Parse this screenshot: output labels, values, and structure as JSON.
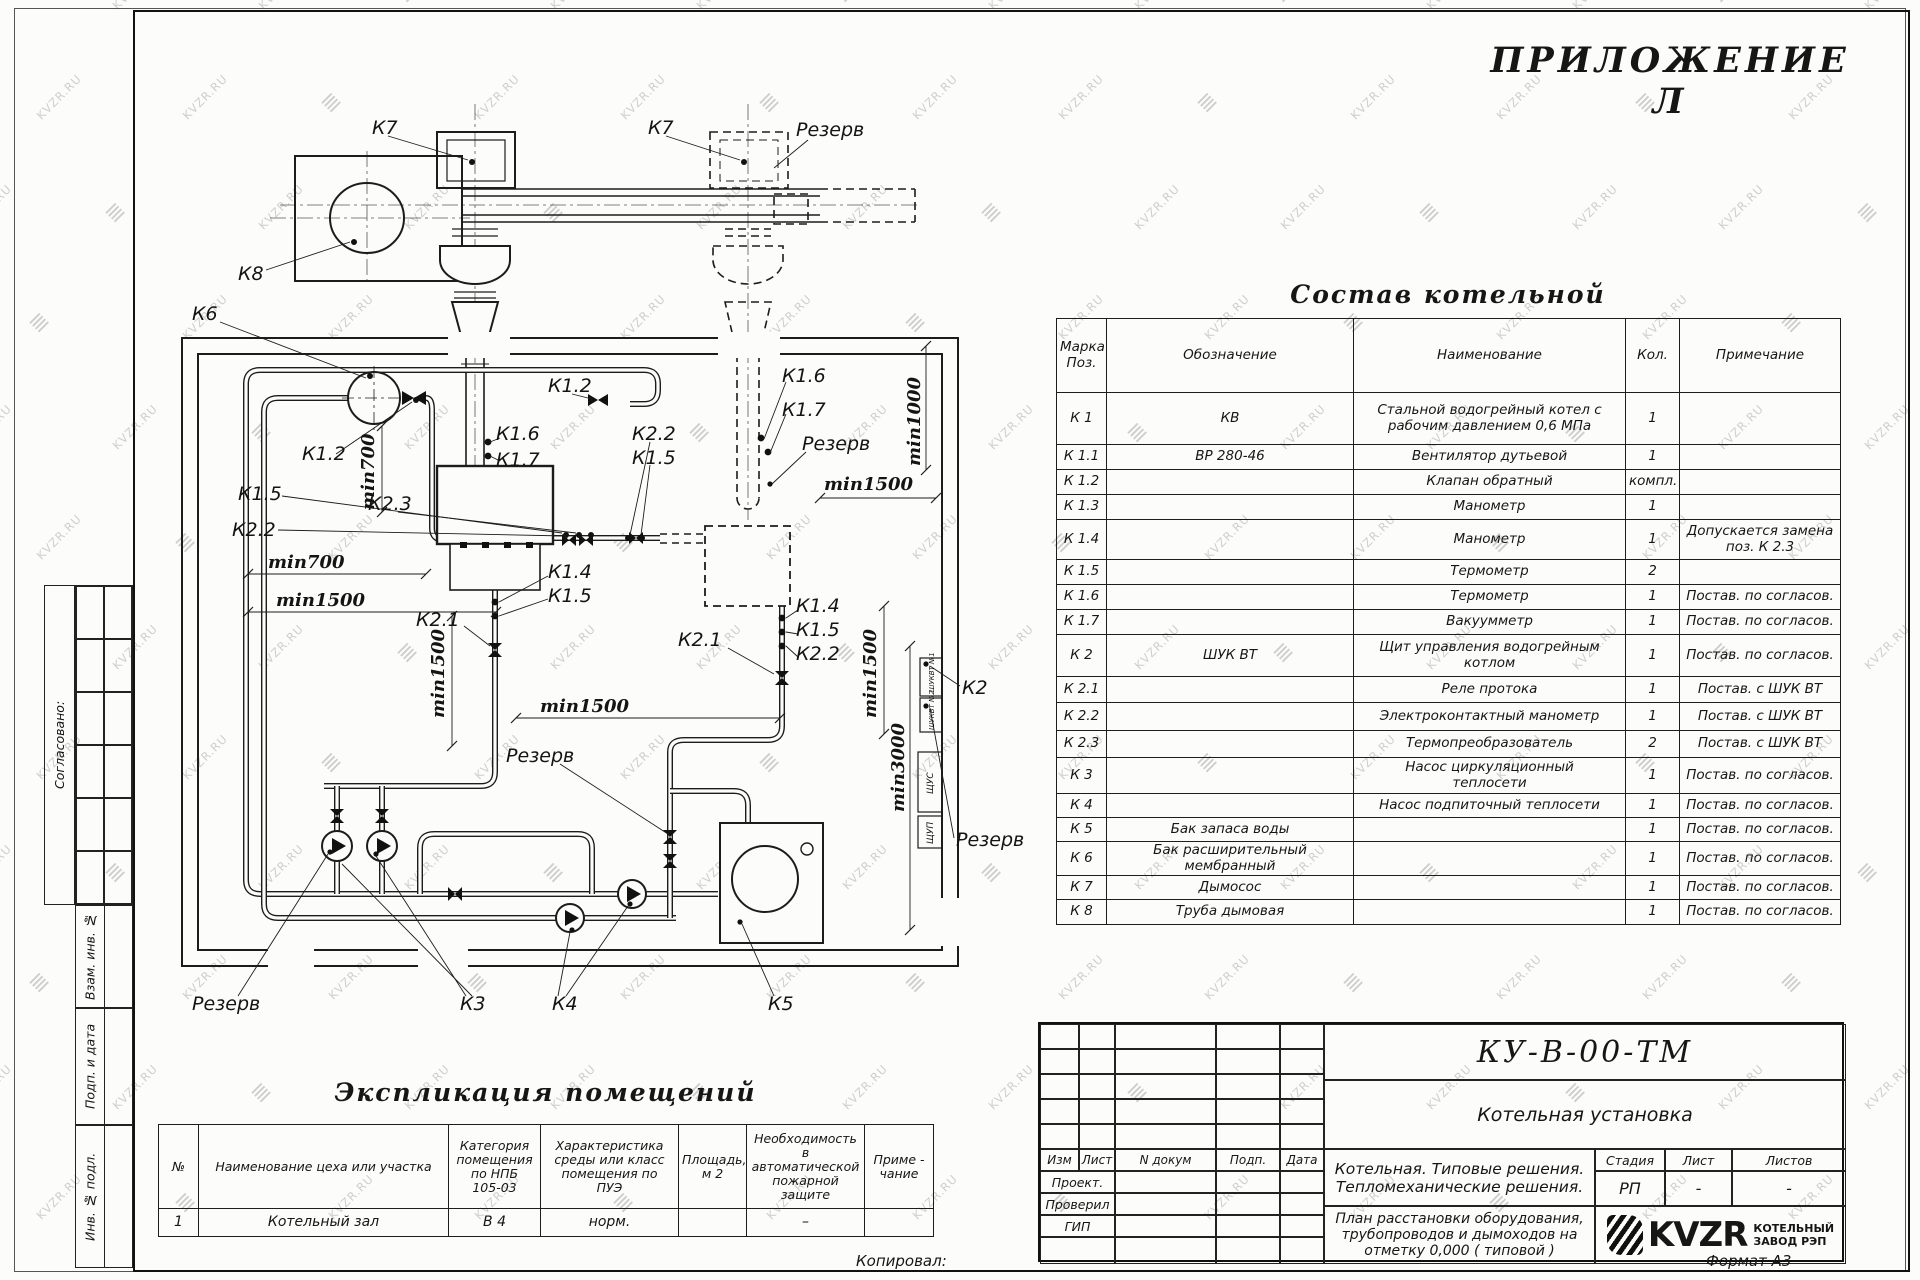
{
  "watermark": {
    "text": "KVZR.RU"
  },
  "page": {
    "appendix_title": "ПРИЛОЖЕНИЕ Л",
    "kopiroval": "Копировал:",
    "format": "Формат А3"
  },
  "side_stamp": {
    "soglasovano": "Согласовано:",
    "vzam": "Взам. инв. №",
    "podp": "Подп. и дата",
    "inv": "Инв. № подл."
  },
  "drawing": {
    "labels": {
      "k7a": "К7",
      "k7b": "К7",
      "k8": "К8",
      "k6": "К6",
      "rezerv_top": "Резерв",
      "rezerv_mid": "Резерв",
      "rezerv_center": "Резерв",
      "rezerv_bottom": "Резерв",
      "rezerv_right": "Резерв",
      "k12_left": "К1.2",
      "k12_top": "К1.2",
      "k15_left": "К1.5",
      "k15_mid": "К1.5",
      "k15_b1": "К1.5",
      "k15_b2": "К1.5",
      "k22_left": "К2.2",
      "k22_mid": "К2.2",
      "k22_b2": "К2.2",
      "k23": "К2.3",
      "k16_left": "К1.6",
      "k16_right": "К1.6",
      "k17_left": "К1.7",
      "k17_right": "К1.7",
      "k14_b1": "К1.4",
      "k14_b2": "К1.4",
      "k21_left": "К2.1",
      "k21_right": "К2.1",
      "k2": "К2",
      "k3": "К3",
      "k4": "К4",
      "k5": "К5",
      "min700v": "min700",
      "min700h": "min700",
      "min1500_left": "min1500",
      "min1500_leftv": "min1500",
      "min1500_center": "min1500",
      "min1500_right": "min1500",
      "min1500_rightv": "min1500",
      "min1000": "min1000",
      "min3000": "min3000",
      "panel1": "ШУКВТ №1",
      "panel2": "ШУКВТ №2",
      "panel3": "ЩУС",
      "panel4": "ЩУП"
    }
  },
  "sostav_table": {
    "title": "Состав котельной",
    "headers": [
      "Марка\nПоз.",
      "Обозначение",
      "Наименование",
      "Кол.",
      "Примечание"
    ],
    "rows": [
      [
        "К 1",
        "КВ",
        "Стальной водогрейный котел с\nрабочим давлением  0,6  МПа",
        "1",
        ""
      ],
      [
        "К 1.1",
        "ВР 280-46",
        "Вентилятор дутьевой",
        "1",
        ""
      ],
      [
        "К 1.2",
        "",
        "Клапан обратный",
        "компл.",
        ""
      ],
      [
        "К 1.3",
        "",
        "Манометр",
        "1",
        ""
      ],
      [
        "К 1.4",
        "",
        "Манометр",
        "1",
        "Допускается замена\nпоз. К 2.3"
      ],
      [
        "К 1.5",
        "",
        "Термометр",
        "2",
        ""
      ],
      [
        "К 1.6",
        "",
        "Термометр",
        "1",
        "Постав. по согласов."
      ],
      [
        "К 1.7",
        "",
        "Вакуумметр",
        "1",
        "Постав. по согласов."
      ],
      [
        "К 2",
        "ШУК ВТ",
        "Щит управления водогрейным\nкотлом",
        "1",
        "Постав. по согласов."
      ],
      [
        "К 2.1",
        "",
        "Реле протока",
        "1",
        "Постав. с ШУК ВТ"
      ],
      [
        "К 2.2",
        "",
        "Электроконтактный манометр",
        "1",
        "Постав. с ШУК ВТ"
      ],
      [
        "К 2.3",
        "",
        "Термопреобразователь",
        "2",
        "Постав. с ШУК ВТ"
      ],
      [
        "К 3",
        "",
        "Насос циркуляционный\nтеплосети",
        "1",
        "Постав. по согласов."
      ],
      [
        "К 4",
        "",
        "Насос подпиточный теплосети",
        "1",
        "Постав. по согласов."
      ],
      [
        "К 5",
        "Бак запаса воды",
        "",
        "1",
        "Постав. по согласов."
      ],
      [
        "К 6",
        "Бак расширительный\nмембранный",
        "",
        "1",
        "Постав. по согласов."
      ],
      [
        "К 7",
        "Дымосос",
        "",
        "1",
        "Постав. по согласов."
      ],
      [
        "К 8",
        "Труба дымовая",
        "",
        "1",
        "Постав. по согласов."
      ]
    ]
  },
  "explication_table": {
    "title": "Экспликация помещений",
    "headers": [
      "№",
      "Наименование цеха или участка",
      "Категория\nпомещения\nпо НПБ\n105-03",
      "Характеристика\nсреды или класс\nпомещения по\nПУЭ",
      "Площадь,\nм 2",
      "Необходимость в\nавтоматической\nпожарной защите",
      "Приме -\nчание"
    ],
    "rows": [
      [
        "1",
        "Котельный зал",
        "В 4",
        "норм.",
        "",
        "–",
        ""
      ]
    ]
  },
  "title_block": {
    "code": "КУ-В-00-ТМ",
    "name": "Котельная установка",
    "izm_row": [
      "Изм",
      "Лист",
      "N докум",
      "Подп.",
      "Дата"
    ],
    "roles": [
      "Проект.",
      "Проверил",
      "ГИП"
    ],
    "project_text": "Котельная. Типовые решения.\nТепломеханические решения.",
    "sheet_text": "План расстановки оборудования,\nтрубопроводов и дымоходов на\nотметку  0,000 ( типовой )",
    "stage_label": "Стадия",
    "sheet_label": "Лист",
    "sheets_label": "Листов",
    "stage": "РП",
    "sheet": "-",
    "sheets": "-",
    "logo_text": "KVZR",
    "logo_sub": "КОТЕЛЬНЫЙ\nЗАВОД РЭП"
  }
}
